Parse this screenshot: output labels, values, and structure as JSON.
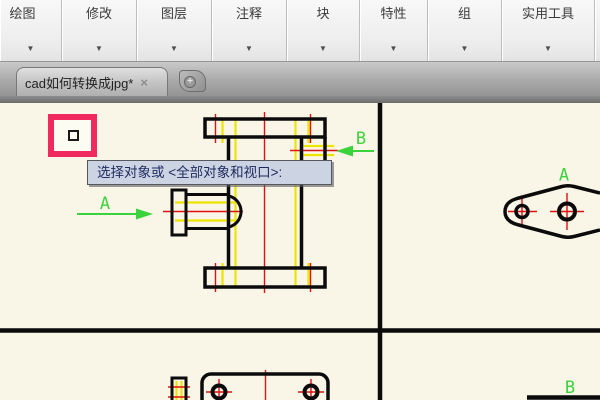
{
  "ribbon": {
    "dropdown_glyph": "▼",
    "panels": [
      {
        "label": "绘图"
      },
      {
        "label": "修改"
      },
      {
        "label": "图层"
      },
      {
        "label": "注释"
      },
      {
        "label": "块"
      },
      {
        "label": "特性"
      },
      {
        "label": "组"
      },
      {
        "label": "实用工具"
      }
    ]
  },
  "tabbar": {
    "active_tab_title": "cad如何转换成jpg*",
    "close_glyph": "×",
    "new_tab_glyph": "+"
  },
  "canvas": {
    "tooltip_text": "选择对象或 <全部对象和视口>:",
    "labels": {
      "front_a": "A",
      "front_b": "B",
      "side_a": "A",
      "bottom_b": "B"
    }
  },
  "colors": {
    "canvas_bg": "#f9f6e8",
    "outline_black": "#0b0b0b",
    "hidden_yellow": "#ede400",
    "centerline_red": "#e01010",
    "section_green": "#3bd33b",
    "highlight_pink": "#f0295f",
    "tooltip_bg": "#ccd3e3",
    "tooltip_text": "#1c2a5e"
  }
}
